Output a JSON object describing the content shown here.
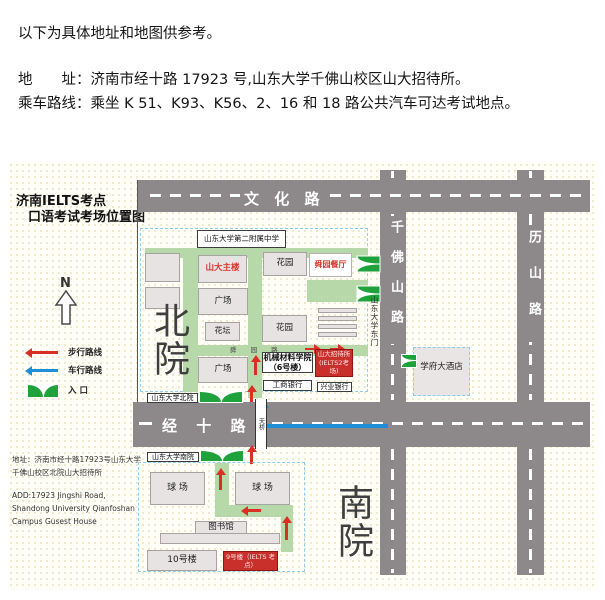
{
  "intro": {
    "line1": "以下为具体地址和地图供参考。",
    "line2": "地　　址：济南市经十路 17923 号,山东大学千佛山校区山大招待所。",
    "line3": "乘车路线：乘坐 K 51、K93、K56、2、16 和 18 路公共汽车可达考试地点。"
  },
  "panel": {
    "title1": "济南IELTS考点",
    "title2": "口语考试考场位置图",
    "compass": "N",
    "legend_walk": "步行路线",
    "legend_drive": "车行路线",
    "legend_entrance": "入 口",
    "addr_cn1": "地址：济南市经十路17923号山东大学",
    "addr_cn2": "千佛山校区北院山大招待所",
    "addr_en1": "ADD:17923 Jingshi Road,",
    "addr_en2": "Shandong University Qianfoshan",
    "addr_en3": "Campus Gusest House"
  },
  "roads": {
    "wenhua": "文 化 路",
    "qianfoshan": "千佛山路",
    "lishan": "历山路",
    "jingshi": "经 十 路"
  },
  "north": {
    "big_label": "北院",
    "school": "山东大学第二附属中学",
    "main_bld": "山大主楼",
    "garden_top": "花园",
    "restaurant": "舜园餐厅",
    "square_top": "广场",
    "flowerbed": "花坛",
    "garden_mid": "花园",
    "inner_road": "舜 园 路",
    "square_bottom": "广场",
    "mech1": "机械材料学院",
    "mech2": "（6号楼）",
    "guest1": "山大招待所",
    "guest2": "(IELTS2考场)",
    "bank_icbc": "工商银行",
    "bank_cib": "兴业银行",
    "gate_north": "山东大学北院",
    "gate_east": "山东大学东门"
  },
  "south": {
    "big_label": "南院",
    "gate_south": "山东大学南院",
    "court_left": "球 场",
    "court_right": "球 场",
    "library": "图书馆",
    "bld10": "10号楼",
    "bld9": "9号楼（IELTS 考点）"
  },
  "landmarks": {
    "hotel": "学府大酒店",
    "bridge": "天桥"
  },
  "colors": {
    "road": "#8d888a",
    "path_green": "#b7d9aa",
    "entrance_green": "#1fa23c",
    "walk_red": "#d93025",
    "drive_blue": "#1e8fd5",
    "highlight_red": "#c9302c"
  }
}
